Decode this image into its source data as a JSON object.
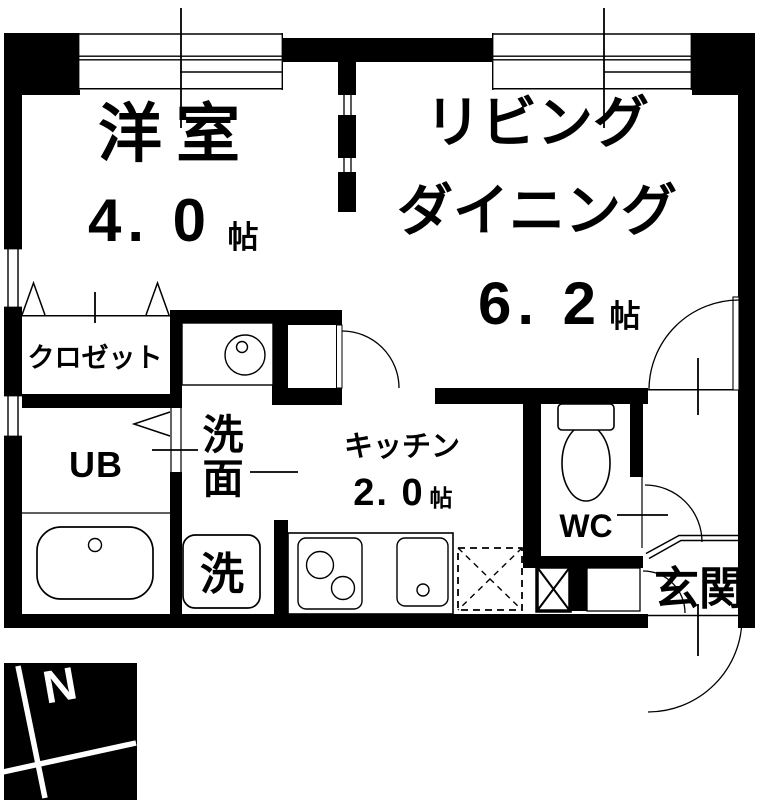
{
  "rooms": {
    "western": {
      "name": "洋室",
      "size": "4. 0",
      "unit": "帖"
    },
    "living": {
      "name_line1": "リビング",
      "name_line2": "ダイニング",
      "size": "6. 2",
      "unit": "帖"
    },
    "closet": {
      "name": "クロゼット"
    },
    "unit_bath": {
      "name": "UB"
    },
    "washroom": {
      "name_line1": "洗",
      "name_line2": "面"
    },
    "laundry": {
      "name": "洗"
    },
    "kitchen": {
      "name": "キッチン",
      "size": "2. 0",
      "unit": "帖"
    },
    "toilet": {
      "name": "WC"
    },
    "entrance": {
      "name": "玄関"
    }
  },
  "compass": {
    "label": "N"
  },
  "colors": {
    "wall": "#000000",
    "background": "#ffffff"
  }
}
